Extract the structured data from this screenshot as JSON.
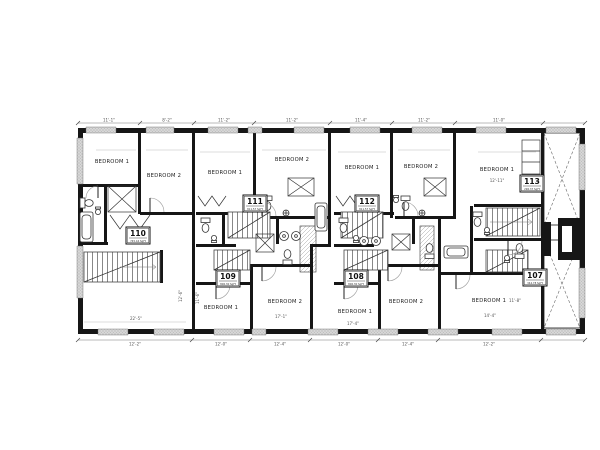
{
  "rooms": [
    {
      "label": "BEDROOM 1"
    },
    {
      "label": "BEDROOM 2"
    },
    {
      "label": "BEDROOM 1"
    },
    {
      "label": "BEDROOM 2"
    },
    {
      "label": "BEDROOM 1"
    },
    {
      "label": "BEDROOM 2"
    },
    {
      "label": "BEDROOM 1"
    },
    {
      "label": "BEDROOM 1"
    },
    {
      "label": "BEDROOM 2"
    },
    {
      "label": "BEDROOM 1"
    },
    {
      "label": "BEDROOM 2"
    },
    {
      "label": "BEDROOM 1"
    }
  ],
  "units": [
    {
      "number": "110",
      "area": "745.44 SqFt"
    },
    {
      "number": "111",
      "area": "811.57 SqFt"
    },
    {
      "number": "112",
      "area": "811.57 SqFt"
    },
    {
      "number": "113",
      "area": "296.37 SqFt"
    },
    {
      "number": "109",
      "area": "806.30 SqFt"
    },
    {
      "number": "108",
      "area": "806.30 SqFt"
    },
    {
      "number": "107",
      "area": "344.78 SqFt"
    }
  ],
  "dims": {
    "top": [
      "11'-1\"",
      "8'-2\"",
      "11'-2\"",
      "11'-2\"",
      "11'-4\"",
      "11'-2\"",
      "11'-0\""
    ],
    "bottom": [
      "12'-2\"",
      "12'-0\"",
      "12'-4\"",
      "12'-0\"",
      "12'-4\"",
      "12'-2\""
    ],
    "interior": [
      "22'-5\"",
      "12'-6\"",
      "11'-6\"",
      "17'-1\"",
      "17'-4\"",
      "14'-4\"",
      "11'-8\"",
      "12'-11\""
    ]
  },
  "colors": {
    "wall": "#161616",
    "window": "#d8d8d8",
    "line": "#555555"
  }
}
